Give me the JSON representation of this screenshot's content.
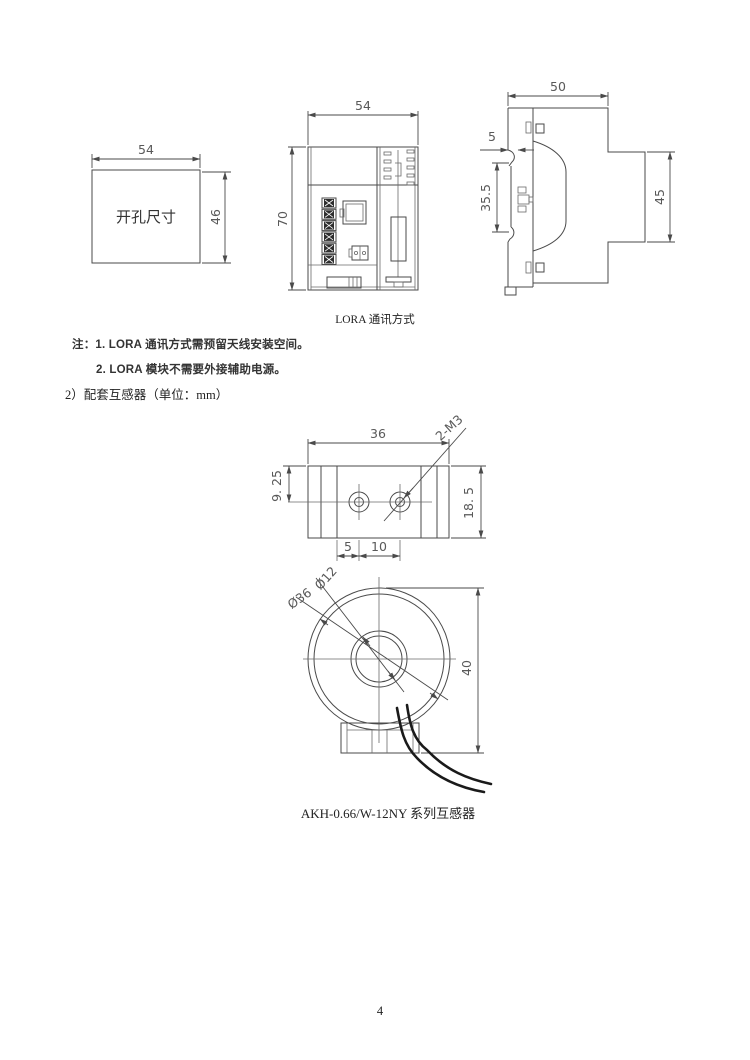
{
  "page": {
    "number": "4",
    "background": "#ffffff"
  },
  "colors": {
    "line": "#4a4a4a",
    "dimension_text": "#595959",
    "body_text": "#333333",
    "wire": "#1a1a1a"
  },
  "top_figures": {
    "cutout": {
      "label": "开孔尺寸",
      "width_dim": "54",
      "height_dim": "46"
    },
    "front_view": {
      "width_dim": "54",
      "height_dim": "70"
    },
    "side_view": {
      "width_dim": "50",
      "clip_dim": "5",
      "rail_dim": "35.5",
      "depth_dim": "45"
    },
    "caption": "LORA 通讯方式"
  },
  "notes": {
    "line1": "注：1. LORA 通讯方式需预留天线安装空间。",
    "line2": "2. LORA 模块不需要外接辅助电源。"
  },
  "section": {
    "heading": "2）配套互感器（单位：mm）"
  },
  "transformer_figures": {
    "top_view": {
      "width_dim": "36",
      "offset_dim": "9. 25",
      "height_dim": "18. 5",
      "spacing_a_dim": "5",
      "spacing_b_dim": "10",
      "thread_label": "2-M3"
    },
    "front_view": {
      "inner_diameter_dim": "Ø12",
      "outer_diameter_dim": "Ø36",
      "height_dim": "40"
    },
    "caption": "AKH-0.66/W-12NY 系列互感器"
  }
}
